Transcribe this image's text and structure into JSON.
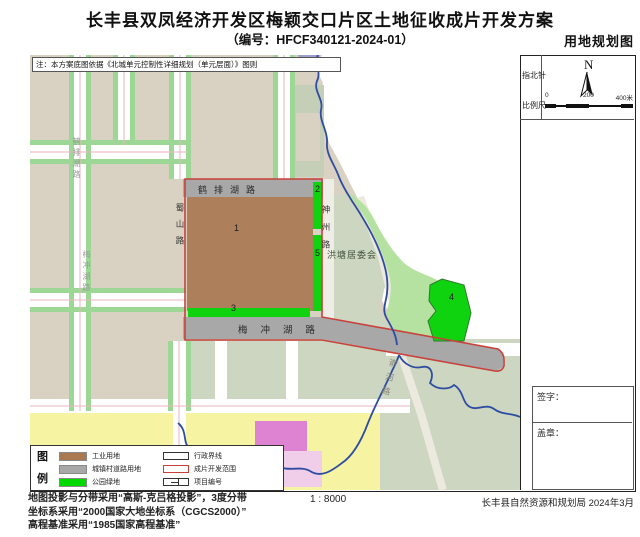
{
  "header": {
    "title": "长丰县双凤经济开发区梅颖交口片区土地征收成片开发方案",
    "subtitle": "（编号：HFCF340121-2024-01）",
    "map_type": "用地规划图"
  },
  "note": "注：本方案底图依据《北城单元控制性详细规划（单元层面）》图则",
  "map": {
    "roads": {
      "hepai": "鹤排湖路",
      "shushan": "蜀山路",
      "shenzhou": "神州路",
      "meichong": "梅冲湖路",
      "yuhe": "嵛河路",
      "west_hepai": "鹤排湖路",
      "west_meichong": "梅冲湖路"
    },
    "area_label": "洪塘居委会",
    "parcel_numbers": {
      "p1": "1",
      "p2": "2",
      "p3": "3",
      "p4": "4",
      "p5": "5"
    }
  },
  "sidebar": {
    "compass_label": "指北针",
    "north": "N",
    "scale_label": "比例尺",
    "scale_ticks": {
      "start": "0",
      "mid": "200",
      "end": "400米"
    },
    "signature_label": "签字：",
    "seal_label": "盖章："
  },
  "legend": {
    "title_chars": {
      "c1": "图",
      "c2": "例"
    },
    "fill_items": [
      {
        "label": "工业用地",
        "color": "#a97a52"
      },
      {
        "label": "城镇村道路用地",
        "color": "#a8a8a8"
      },
      {
        "label": "公园绿地",
        "color": "#00d800"
      }
    ],
    "line_items": [
      {
        "label": "行政界线"
      },
      {
        "label": "成片开发范围"
      },
      {
        "label": "项目编号"
      }
    ]
  },
  "footer": {
    "projection_line1": "地图投影与分带采用“高斯-克吕格投影”，3度分带",
    "projection_line2": "坐标系采用“2000国家大地坐标系（CGCS2000）”",
    "projection_line3": "高程基准采用“1985国家高程基准”",
    "scale_text": "1 : 8000",
    "agency": "长丰县自然资源和规划局  2024年3月"
  },
  "colors": {
    "industrial_brown": "#ad7f5b",
    "road_gray": "#a8a8a8",
    "park_green": "#0fd30f",
    "development_red": "#c8413b",
    "admin_blue": "#2f4da0",
    "base_tan": "#d9d1c1",
    "muted_green": "#ccd6c0",
    "bright_green_strip": "#b5e2a0",
    "yellow_parcel": "#f6f3a3"
  }
}
